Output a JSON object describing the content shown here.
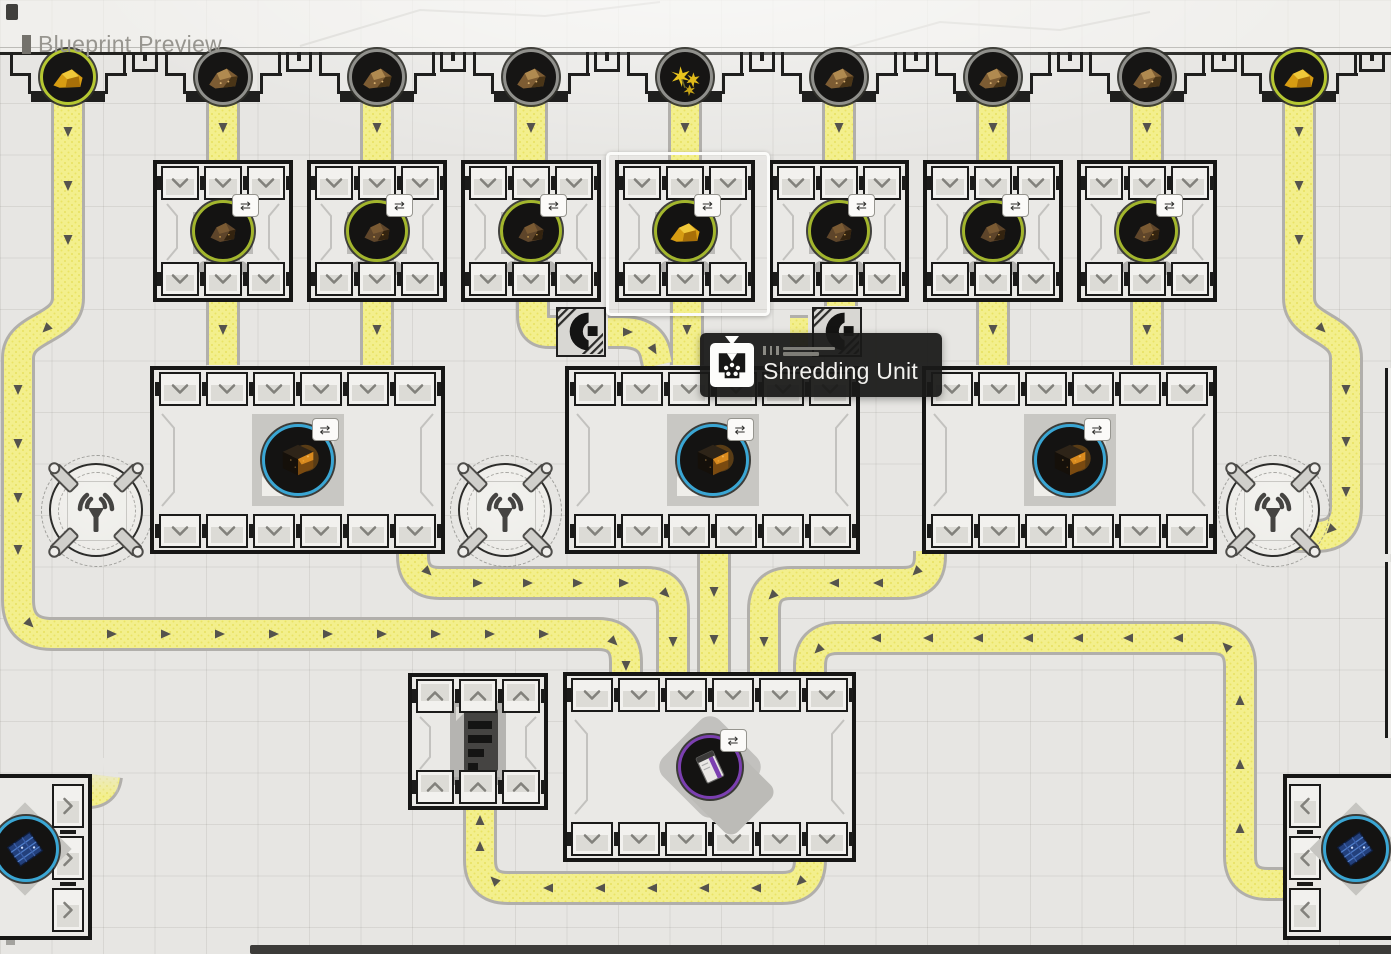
{
  "header": {
    "title": "Blueprint Preview"
  },
  "tooltip": {
    "title": "Shredding Unit",
    "icon": "shredder-icon"
  },
  "colors": {
    "belt": "#f3ef8d",
    "belt_border": "#b1afab",
    "frame": "#161615",
    "ring_lime": "#b6c832",
    "ring_gray": "#90908c",
    "ring_green": "#a3b62d",
    "ring_cyan": "#3aa6d4",
    "ring_purple": "#7b3fb0",
    "arrow": "#55534d"
  },
  "resource_nodes": [
    {
      "id": "node-1",
      "x": 68,
      "item": "gold-ore",
      "ring": "lime"
    },
    {
      "id": "node-2",
      "x": 223,
      "item": "brown-ore",
      "ring": "gray"
    },
    {
      "id": "node-3",
      "x": 377,
      "item": "brown-ore",
      "ring": "gray"
    },
    {
      "id": "node-4",
      "x": 531,
      "item": "brown-ore",
      "ring": "gray"
    },
    {
      "id": "node-5",
      "x": 685,
      "item": "yellow-flower",
      "ring": "gray"
    },
    {
      "id": "node-6",
      "x": 839,
      "item": "brown-ore",
      "ring": "gray"
    },
    {
      "id": "node-7",
      "x": 993,
      "item": "brown-ore",
      "ring": "gray"
    },
    {
      "id": "node-8",
      "x": 1147,
      "item": "brown-ore",
      "ring": "gray"
    },
    {
      "id": "node-9",
      "x": 1299,
      "item": "gold-ore",
      "ring": "lime"
    }
  ],
  "shredder_machines": [
    {
      "id": "shredder-1",
      "x": 223,
      "item": "dark-ore",
      "selected": false
    },
    {
      "id": "shredder-2",
      "x": 377,
      "item": "dark-ore",
      "selected": false
    },
    {
      "id": "shredder-3",
      "x": 531,
      "item": "dark-ore",
      "selected": false
    },
    {
      "id": "shredder-4",
      "x": 685,
      "item": "gold-ore",
      "selected": true
    },
    {
      "id": "shredder-5",
      "x": 839,
      "item": "dark-ore",
      "selected": false
    },
    {
      "id": "shredder-6",
      "x": 993,
      "item": "dark-ore",
      "selected": false
    },
    {
      "id": "shredder-7",
      "x": 1147,
      "item": "dark-ore",
      "selected": false
    }
  ],
  "collector_buildings": [
    {
      "id": "collector-1",
      "x": 150,
      "item": "dark-cube"
    },
    {
      "id": "collector-2",
      "x": 565,
      "item": "dark-cube"
    },
    {
      "id": "collector-3",
      "x": 922,
      "item": "dark-cube"
    }
  ],
  "signal_towers": [
    {
      "x": 96
    },
    {
      "x": 505
    },
    {
      "x": 1273
    }
  ],
  "bottom_buildings": {
    "storage_small": {
      "x": 408,
      "y": 673
    },
    "processor_wide": {
      "x": 563,
      "y": 672,
      "item": "purple-unit"
    },
    "corner_left": {
      "item": "blue-circuit"
    },
    "corner_right": {
      "item": "blue-circuit"
    }
  },
  "tunnels": [
    {
      "x": 556,
      "y": 307
    },
    {
      "x": 812,
      "y": 307
    }
  ]
}
